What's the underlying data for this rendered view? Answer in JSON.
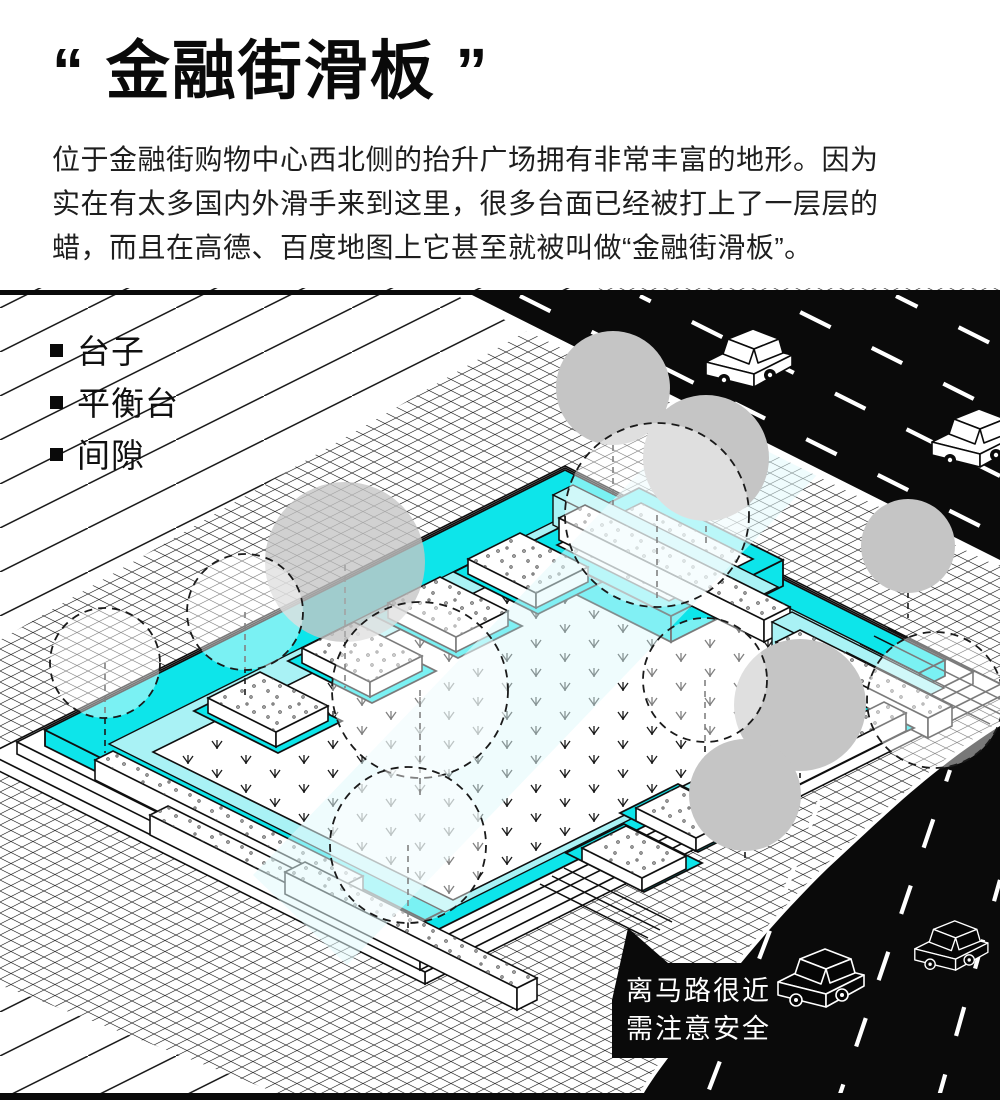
{
  "header": {
    "title": "“ 金融街滑板 ”",
    "paragraph": "位于金融街购物中心西北侧的抬升广场拥有非常丰富的地形。因为\n实在有太多国内外滑手来到这里，很多台面已经被打上了一层层的\n蜡，而且在高德、百度地图上它甚至就被叫做“金融街滑板”。"
  },
  "features": {
    "items": [
      {
        "label": "台子"
      },
      {
        "label": "平衡台"
      },
      {
        "label": "间隙"
      }
    ]
  },
  "warning": {
    "line1": "离马路很近",
    "line2": "需注意安全"
  },
  "palette": {
    "accent_cyan": "#0DE5EA",
    "pale_cyan": "#A9F2F5",
    "tree_gray": "#C5C5C5",
    "road_black": "#0A0A0A",
    "text_black": "#0A0A0A",
    "surface_white": "#FFFFFF"
  },
  "icons": {
    "bullet": "square-bullet",
    "tree": "tree-canopy-icon",
    "car": "car-icon",
    "bubble": "speech-bubble"
  }
}
